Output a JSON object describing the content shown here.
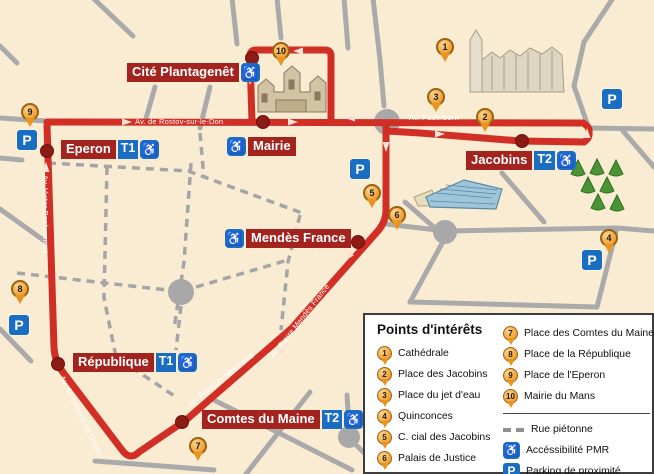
{
  "pois": [
    {
      "num": "1",
      "label": "Cathédrale"
    },
    {
      "num": "2",
      "label": "Place des Jacobins"
    },
    {
      "num": "3",
      "label": "Place du jet d'eau"
    },
    {
      "num": "4",
      "label": "Quinconces"
    },
    {
      "num": "5",
      "label": "C. cial des Jacobins"
    },
    {
      "num": "6",
      "label": "Palais de Justice"
    },
    {
      "num": "7",
      "label": "Place des Comtes du Maine"
    },
    {
      "num": "8",
      "label": "Place de la République"
    },
    {
      "num": "9",
      "label": "Place de l'Eperon"
    },
    {
      "num": "10",
      "label": "Mairie du Mans"
    }
  ],
  "stops": {
    "cite": {
      "label": "Cité Plantagenêt"
    },
    "eperon": {
      "label": "Eperon"
    },
    "mairie": {
      "label": "Mairie"
    },
    "jacobins": {
      "label": "Jacobins"
    },
    "mendes": {
      "label": "Mendès France"
    },
    "republique": {
      "label": "République"
    },
    "comtes": {
      "label": "Comtes du Maine"
    }
  },
  "badges": {
    "t1": "T1",
    "t2": "T2"
  },
  "icons": {
    "wheelchair": "♿",
    "parking": "P"
  },
  "streets": {
    "rostov": "Av. de Rostov-sur-le-Don",
    "paderborn": "Av. Paderborn",
    "bonhommet": "Av. Victor Bonhommet",
    "gaulle": "Av. du Général de Gaulle",
    "mitterrand": "Av. François Mitterrand",
    "mendes_france": "Av. Pierre Mendès France"
  },
  "legend": {
    "title": "Points d'intérêts",
    "pedestrian": "Rue piétonne",
    "pmr": "Accéssibilité PMR",
    "parking": "Parking de proximité"
  },
  "colors": {
    "background": "#f9ecd3",
    "route_red": "#d12f26",
    "stop_label_red": "#a3231e",
    "badge_blue": "#1a6ec2",
    "marker_orange": "#f09d2e",
    "road_gray": "#aaaaaa",
    "stop_dot": "#8c1a15"
  }
}
